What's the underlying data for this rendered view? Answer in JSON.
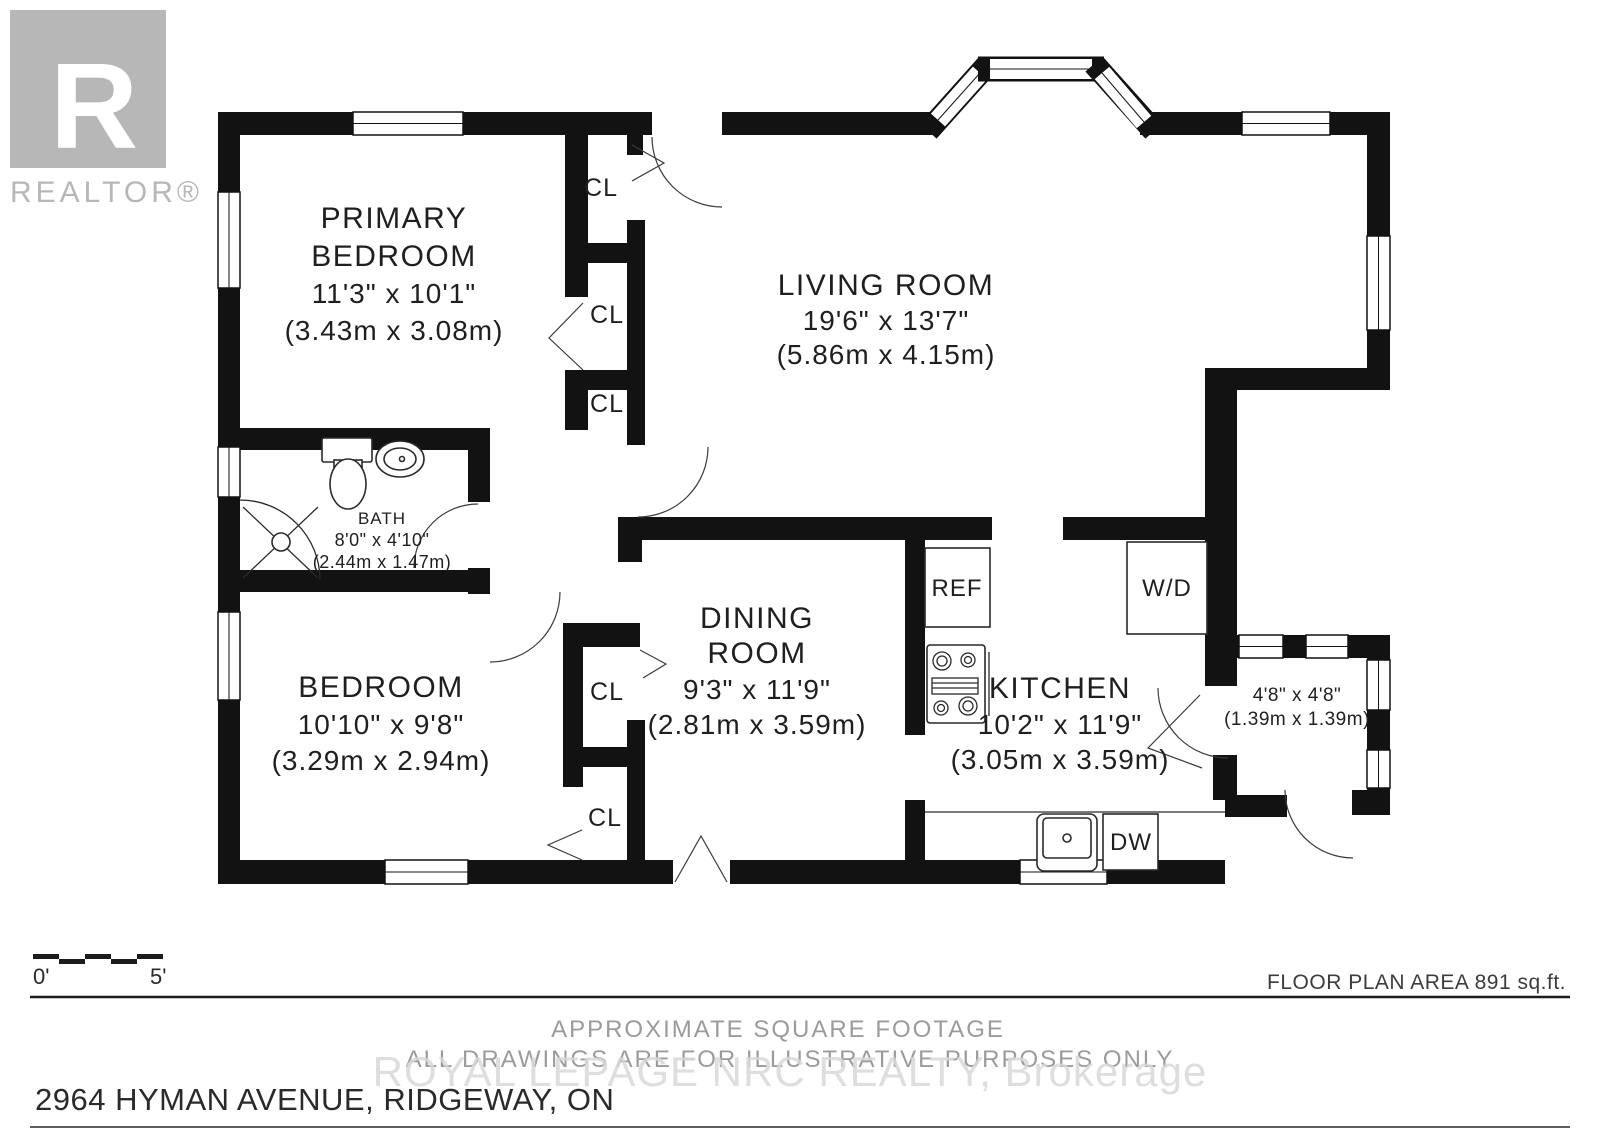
{
  "watermark": {
    "logo_letter": "R",
    "realtor_text": "REALTOR®",
    "brokerage": "ROYAL LEPAGE NRC REALTY, Brokerage"
  },
  "rooms": {
    "primary_bedroom": {
      "name_line1": "PRIMARY",
      "name_line2": "BEDROOM",
      "dim_imperial": "11'3\" x 10'1\"",
      "dim_metric": "(3.43m x 3.08m)"
    },
    "living_room": {
      "name": "LIVING ROOM",
      "dim_imperial": "19'6\" x 13'7\"",
      "dim_metric": "(5.86m x 4.15m)"
    },
    "bath": {
      "name": "BATH",
      "dim_imperial": "8'0\" x 4'10\"",
      "dim_metric": "(2.44m x 1.47m)"
    },
    "bedroom": {
      "name": "BEDROOM",
      "dim_imperial": "10'10\" x 9'8\"",
      "dim_metric": "(3.29m x 2.94m)"
    },
    "dining_room": {
      "name_line1": "DINING",
      "name_line2": "ROOM",
      "dim_imperial": "9'3\" x 11'9\"",
      "dim_metric": "(2.81m x 3.59m)"
    },
    "kitchen": {
      "name": "KITCHEN",
      "dim_imperial": "10'2\" x 11'9\"",
      "dim_metric": "(3.05m x 3.59m)"
    },
    "nook": {
      "dim_imperial": "4'8\" x 4'8\"",
      "dim_metric": "(1.39m x 1.39m)"
    }
  },
  "labels": {
    "closet": "CL",
    "fridge": "REF",
    "washer_dryer": "W/D",
    "dishwasher": "DW"
  },
  "scale": {
    "start": "0'",
    "end": "5'"
  },
  "footer": {
    "area": "FLOOR PLAN AREA 891 sq.ft.",
    "note1": "APPROXIMATE SQUARE FOOTAGE",
    "note2": "ALL DRAWINGS ARE FOR ILLUSTRATIVE PURPOSES ONLY",
    "address": "2964 HYMAN AVENUE, RIDGEWAY, ON"
  },
  "colors": {
    "wall": "#121212",
    "watermark_gray": "#b7b7b7",
    "note_gray": "#9b9b9b"
  }
}
